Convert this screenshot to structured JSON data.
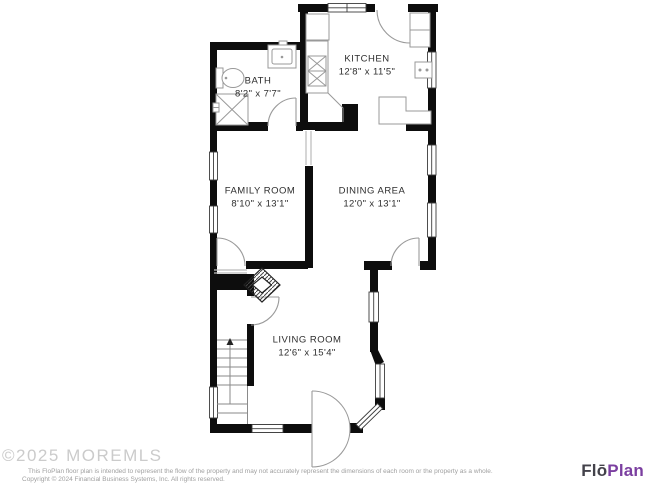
{
  "plan": {
    "rooms": [
      {
        "name": "KITCHEN",
        "dims": "12'8\" x 11'5\""
      },
      {
        "name": "BATH",
        "dims": "8'2\" x 7'7\""
      },
      {
        "name": "FAMILY ROOM",
        "dims": "8'10\" x 13'1\""
      },
      {
        "name": "DINING AREA",
        "dims": "12'0\" x 13'1\""
      },
      {
        "name": "LIVING ROOM",
        "dims": "12'6\" x 15'4\""
      }
    ],
    "features": [
      "bath-toilet",
      "bath-sink",
      "bath-shower",
      "kitchen-stove",
      "kitchen-sink",
      "kitchen-counters",
      "refrigerator",
      "fireplace",
      "staircase-up",
      "bay-window",
      "front-door"
    ]
  },
  "watermark": "©2025 MOREMLS",
  "footer": {
    "disclaimer_line1": "This FloPlan floor plan is intended to represent the flow of the property and may not accurately represent the dimensions of each room or the property as a whole.",
    "disclaimer_line2": "Copyright © 2024 Financial Business Systems, Inc. All rights reserved."
  },
  "logo": {
    "part1": "Flō",
    "part2": "Plan"
  },
  "colors": {
    "wall": "#0d0d0d",
    "detail_gray": "#999999",
    "logo_dark": "#43424a",
    "logo_purple": "#7b3fa0",
    "watermark": "#cbcbcb",
    "disclaimer": "#a0a0a0"
  }
}
